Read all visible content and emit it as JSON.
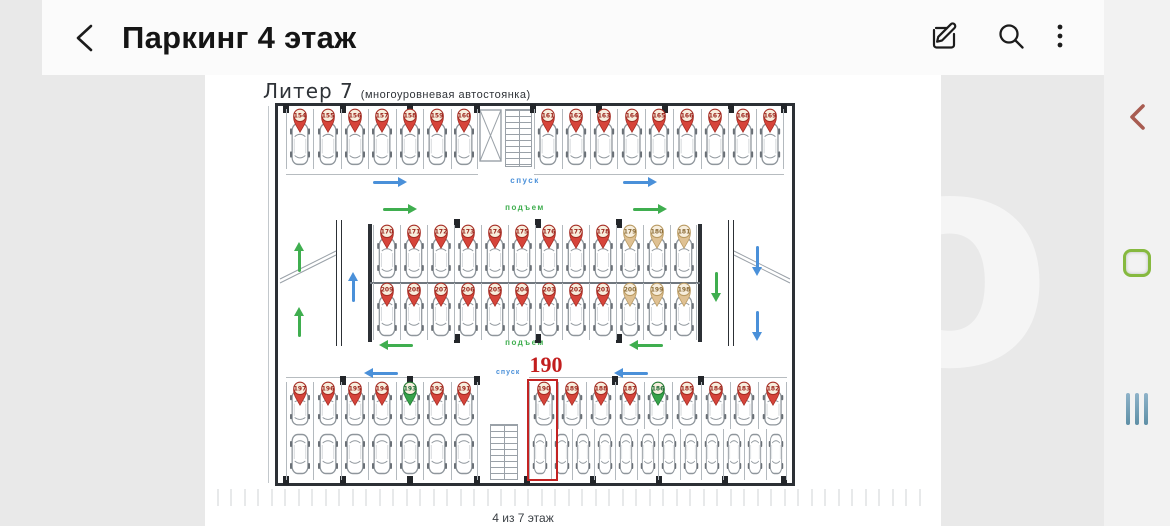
{
  "header": {
    "title": "Паркинг 4 этаж",
    "back_icon": "chevron-left-icon",
    "actions": {
      "edit": "edit-square-icon",
      "search": "magnifier-icon",
      "menu": "kebab-vertical-icon"
    }
  },
  "nav_rail": {
    "back": {
      "icon": "chevron-left-icon",
      "color": "#a85c51"
    },
    "home": {
      "icon": "squircle-outline-icon",
      "color": "#86b93f"
    },
    "recents": {
      "icon": "three-bars-icon",
      "color": "#5e8fa6"
    }
  },
  "watermark": "avito",
  "sheet": {
    "title": "Литер 7",
    "subtitle": "(многоуровневая автостоянка)",
    "caption": "4 из 7 этаж",
    "selected_spot": "190"
  },
  "lanes": {
    "top_down": {
      "label": "спуск",
      "color": "#4a90d9",
      "direction": "right"
    },
    "top_up": {
      "label": "подъем",
      "color": "#3fae4f",
      "direction": "right"
    },
    "bottom_up": {
      "label": "подъем",
      "color": "#3fae4f",
      "direction": "left"
    },
    "bottom_down": {
      "label": "спуск",
      "color": "#4a90d9",
      "direction": "left"
    }
  },
  "plan": {
    "groups": {
      "top_left": {
        "spots": [
          {
            "num": "154",
            "state": "red"
          },
          {
            "num": "155",
            "state": "red"
          },
          {
            "num": "156",
            "state": "red"
          },
          {
            "num": "157",
            "state": "red"
          },
          {
            "num": "158",
            "state": "red"
          },
          {
            "num": "159",
            "state": "red"
          },
          {
            "num": "160",
            "state": "red"
          }
        ]
      },
      "top_right": {
        "spots": [
          {
            "num": "161",
            "state": "red"
          },
          {
            "num": "162",
            "state": "red"
          },
          {
            "num": "163",
            "state": "red"
          },
          {
            "num": "164",
            "state": "red"
          },
          {
            "num": "165",
            "state": "red"
          },
          {
            "num": "166",
            "state": "red"
          },
          {
            "num": "167",
            "state": "red"
          },
          {
            "num": "168",
            "state": "red"
          },
          {
            "num": "169",
            "state": "red"
          }
        ]
      },
      "mid_upper": {
        "spots": [
          {
            "num": "170",
            "state": "red"
          },
          {
            "num": "171",
            "state": "red"
          },
          {
            "num": "172",
            "state": "red"
          },
          {
            "num": "173",
            "state": "red"
          },
          {
            "num": "174",
            "state": "red"
          },
          {
            "num": "175",
            "state": "red"
          },
          {
            "num": "176",
            "state": "red"
          },
          {
            "num": "177",
            "state": "red"
          },
          {
            "num": "178",
            "state": "red"
          },
          {
            "num": "179",
            "state": "tan"
          },
          {
            "num": "180",
            "state": "tan"
          },
          {
            "num": "181",
            "state": "tan"
          }
        ]
      },
      "mid_lower": {
        "spots": [
          {
            "num": "209",
            "state": "red"
          },
          {
            "num": "208",
            "state": "red"
          },
          {
            "num": "207",
            "state": "red"
          },
          {
            "num": "206",
            "state": "red"
          },
          {
            "num": "205",
            "state": "red"
          },
          {
            "num": "204",
            "state": "red"
          },
          {
            "num": "203",
            "state": "red"
          },
          {
            "num": "202",
            "state": "red"
          },
          {
            "num": "201",
            "state": "red"
          },
          {
            "num": "200",
            "state": "tan"
          },
          {
            "num": "199",
            "state": "tan"
          },
          {
            "num": "198",
            "state": "tan"
          }
        ]
      },
      "bottom_left": {
        "spots": [
          {
            "num": "197",
            "state": "red"
          },
          {
            "num": "196",
            "state": "red"
          },
          {
            "num": "195",
            "state": "red"
          },
          {
            "num": "194",
            "state": "red"
          },
          {
            "num": "193",
            "state": "green"
          },
          {
            "num": "192",
            "state": "red"
          },
          {
            "num": "191",
            "state": "red"
          }
        ]
      },
      "bottom_right": {
        "spots": [
          {
            "num": "190",
            "state": "red",
            "selected": true
          },
          {
            "num": "189",
            "state": "red"
          },
          {
            "num": "188",
            "state": "red"
          },
          {
            "num": "187",
            "state": "red"
          },
          {
            "num": "186",
            "state": "green"
          },
          {
            "num": "185",
            "state": "red"
          },
          {
            "num": "184",
            "state": "red"
          },
          {
            "num": "183",
            "state": "red"
          },
          {
            "num": "182",
            "state": "red"
          }
        ]
      },
      "bottom_left_inner": {
        "car_count": 7
      },
      "bottom_right_inner": {
        "car_count": 12
      }
    }
  },
  "colors": {
    "pin_red": "#d6443a",
    "pin_green": "#37a34a",
    "pin_tan": "#dfc193",
    "selection_box": "#c32222",
    "lane_blue": "#4a90d9",
    "lane_green": "#3fae4f",
    "walls": "#2c3035",
    "header_bg": "#fbfbfb",
    "page_bg": "#e9e9e9",
    "rail_bg": "#f2f2f2"
  }
}
